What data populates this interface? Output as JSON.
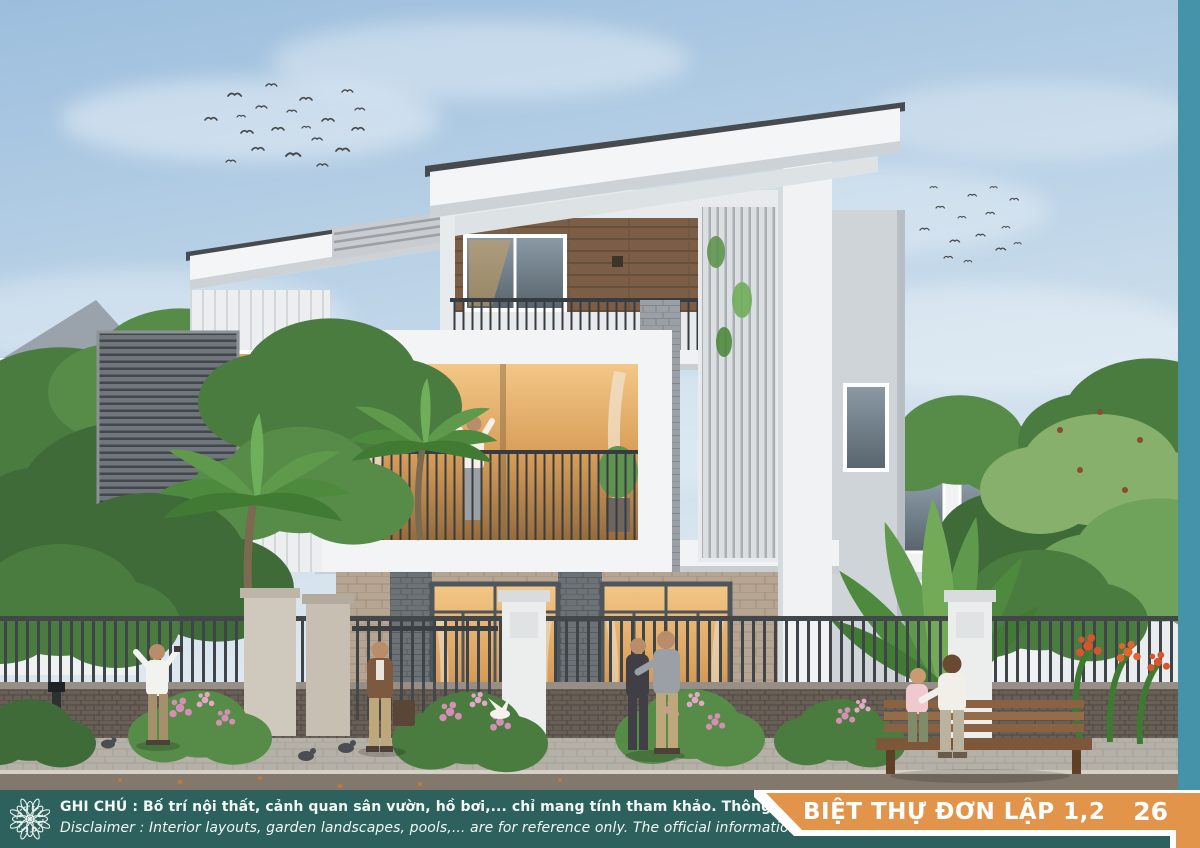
{
  "illustration": "villa-exterior-rendering",
  "footer": {
    "note_line_vi": "GHI CHÚ : Bố trí nội thất, cảnh quan sân vườn, hồ bơi,... chỉ mang tính tham khảo. Thông tin chính thức phải căn cứ theo hợp đồng.",
    "note_line_en": "Disclaimer : Interior layouts, garden landscapes, pools,... are for reference only. The official information must be based on the contract.",
    "banner_title": "BIỆT THỰ ĐƠN LẬP 1,2",
    "page_number": "26",
    "ornament_icon": "rosette-mandala-icon"
  },
  "colors": {
    "footer-teal": "#2c615d",
    "banner-orange": "#e2944a",
    "side-strip-blue": "#4493a8",
    "footer-text": "#f2f7f5",
    "banner-text": "#ffffff"
  }
}
